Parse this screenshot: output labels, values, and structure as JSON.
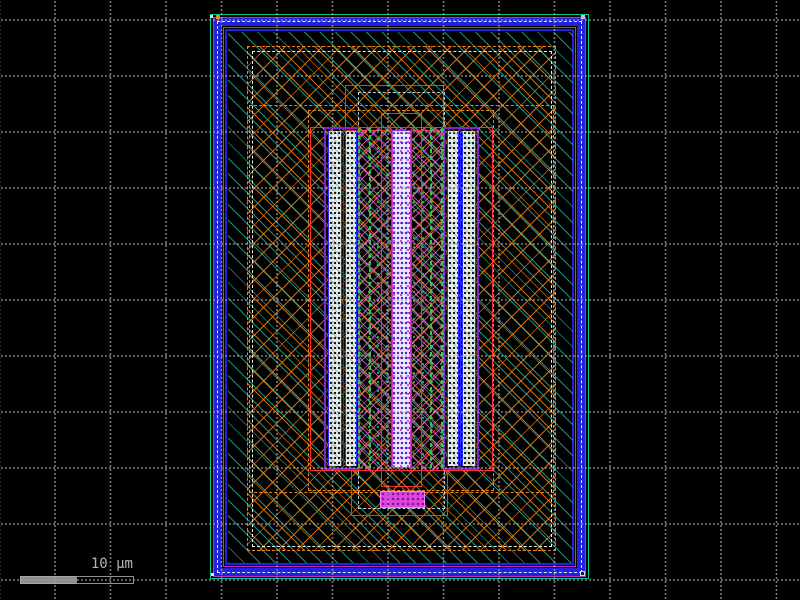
{
  "viewer": {
    "canvas_bg": "#000000",
    "grid": {
      "pitch_px": 56,
      "dot_color": "#a0a0a0",
      "style": "dotted-lines"
    },
    "scale_bar": {
      "label": "10 µm",
      "bar_color": "#8f8f8f",
      "segments": [
        "filled",
        "outlined"
      ]
    }
  },
  "layout_cell": {
    "description": "IC layout cell with guard ring, well, and central transistor stack",
    "layers": [
      {
        "name": "cell-boundary",
        "color": "#00c890",
        "style": "solid-outline"
      },
      {
        "name": "guard-ring-metal",
        "color": "#2222dd",
        "style": "band"
      },
      {
        "name": "guard-ring-edge",
        "color": "#c030c0",
        "style": "solid-outline"
      },
      {
        "name": "ring-center-line",
        "color": "#dfe8ff",
        "style": "dashed-line"
      },
      {
        "name": "substrate-hatch",
        "color": "#20a88e",
        "style": "diagonal-hatch"
      },
      {
        "name": "well-region",
        "color": "#f08414",
        "style": "cross-hatch-dashed-outline"
      },
      {
        "name": "well-inset",
        "color": "#e8f4e8",
        "style": "dashed-outline"
      },
      {
        "name": "diffusion",
        "color": "#ff2d2d",
        "style": "solid-outline"
      },
      {
        "name": "pale-inset",
        "color": "#a8d4f0",
        "style": "dashed-outline"
      },
      {
        "name": "implant-hatch",
        "color": "#e45cd4",
        "style": "cross-hatch"
      },
      {
        "name": "contact-array",
        "color": "#ececec",
        "style": "dotted-fill"
      },
      {
        "name": "contact-frame",
        "color": "#7d26cd",
        "style": "solid-outline"
      },
      {
        "name": "poly-gate",
        "color": "#2ecc40",
        "style": "dashed-line"
      },
      {
        "name": "via-stack",
        "color": "#4526cf",
        "style": "speckle-fill"
      },
      {
        "name": "pad",
        "color": "#dd44dd",
        "style": "solid-fill"
      }
    ]
  }
}
